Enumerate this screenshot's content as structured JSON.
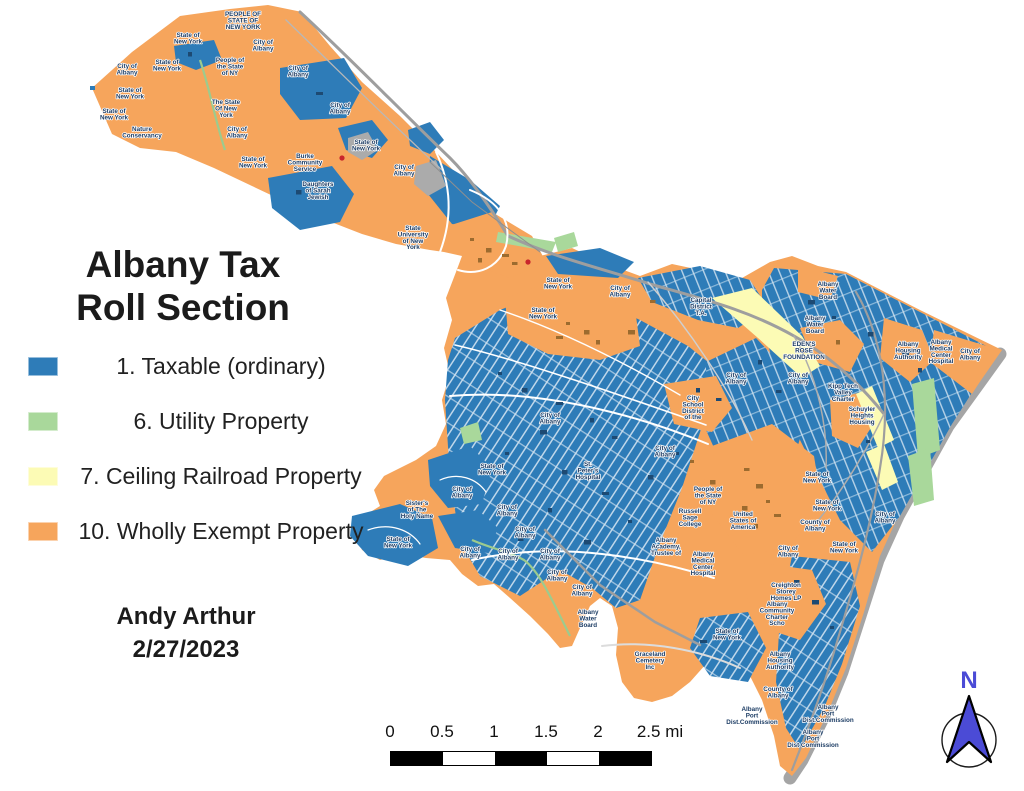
{
  "title": {
    "lines": [
      "Albany Tax",
      "Roll Section"
    ]
  },
  "legend": {
    "items": [
      {
        "label": "1. Taxable (ordinary)",
        "color": "#2E7CB8"
      },
      {
        "label": "6. Utility Property",
        "color": "#A9D89B"
      },
      {
        "label": "7. Ceiling Railroad Property",
        "color": "#FCFBB5"
      },
      {
        "label": "10. Wholly Exempt Property",
        "color": "#F6A55C"
      }
    ]
  },
  "credit": {
    "lines": [
      "Andy Arthur",
      "2/27/2023"
    ]
  },
  "scale_bar": {
    "tick_labels": [
      "0",
      "0.5",
      "1",
      "1.5",
      "2",
      "2.5 mi"
    ],
    "segment_colors": [
      "#000000",
      "#ffffff",
      "#000000",
      "#ffffff",
      "#000000"
    ]
  },
  "compass": {
    "label": "N",
    "color": "#4B4BD6"
  },
  "map": {
    "colors": {
      "taxable_blue": "#2E7CB8",
      "utility_green": "#A9D89B",
      "railroad_yellow": "#FCFBB5",
      "exempt_orange": "#F6A55C",
      "label_navy": "#1C3C64",
      "river_shadow_gray": "#9B9B9B"
    },
    "labels": [
      {
        "x": 243,
        "y": 16,
        "lines": [
          "PEOPLE OF",
          "STATE OF",
          "NEW YORK"
        ]
      },
      {
        "x": 188,
        "y": 37,
        "lines": [
          "State of",
          "New York"
        ]
      },
      {
        "x": 263,
        "y": 44,
        "lines": [
          "City of",
          "Albany"
        ]
      },
      {
        "x": 230,
        "y": 62,
        "lines": [
          "People of",
          "the State",
          "of NY"
        ]
      },
      {
        "x": 167,
        "y": 64,
        "lines": [
          "State of",
          "New York"
        ]
      },
      {
        "x": 127,
        "y": 68,
        "lines": [
          "City of",
          "Albany"
        ]
      },
      {
        "x": 298,
        "y": 70,
        "lines": [
          "City of",
          "Albany"
        ]
      },
      {
        "x": 130,
        "y": 92,
        "lines": [
          "State of",
          "New York"
        ]
      },
      {
        "x": 226,
        "y": 104,
        "lines": [
          "The State",
          "Of New",
          "York"
        ]
      },
      {
        "x": 340,
        "y": 107,
        "lines": [
          "City of",
          "Albany"
        ]
      },
      {
        "x": 114,
        "y": 113,
        "lines": [
          "State of",
          "New York"
        ]
      },
      {
        "x": 237,
        "y": 131,
        "lines": [
          "City of",
          "Albany"
        ]
      },
      {
        "x": 142,
        "y": 131,
        "lines": [
          "Nature",
          "Conservancy"
        ]
      },
      {
        "x": 366,
        "y": 144,
        "lines": [
          "State of",
          "New York"
        ]
      },
      {
        "x": 253,
        "y": 161,
        "lines": [
          "State of",
          "New York"
        ]
      },
      {
        "x": 305,
        "y": 158,
        "lines": [
          "Burke",
          "Community",
          "Service"
        ]
      },
      {
        "x": 404,
        "y": 169,
        "lines": [
          "City of",
          "Albany"
        ]
      },
      {
        "x": 318,
        "y": 186,
        "lines": [
          "Daughters",
          "of Sarah",
          "Jewish"
        ]
      },
      {
        "x": 413,
        "y": 230,
        "lines": [
          "State",
          "University",
          "of New",
          "York"
        ]
      },
      {
        "x": 558,
        "y": 282,
        "lines": [
          "State of",
          "New York"
        ]
      },
      {
        "x": 620,
        "y": 290,
        "lines": [
          "City of",
          "Albany"
        ]
      },
      {
        "x": 701,
        "y": 302,
        "lines": [
          "Capital",
          "District",
          "T.A."
        ]
      },
      {
        "x": 543,
        "y": 312,
        "lines": [
          "State of",
          "New York"
        ]
      },
      {
        "x": 828,
        "y": 286,
        "lines": [
          "Albany",
          "Water",
          "Board"
        ]
      },
      {
        "x": 815,
        "y": 320,
        "lines": [
          "Albany",
          "Water",
          "Board"
        ]
      },
      {
        "x": 804,
        "y": 346,
        "lines": [
          "EDEN'S",
          "ROSE",
          "FOUNDATION"
        ]
      },
      {
        "x": 908,
        "y": 346,
        "lines": [
          "Albany",
          "Housing",
          "Authority"
        ]
      },
      {
        "x": 941,
        "y": 344,
        "lines": [
          "Albany",
          "Medical",
          "Center",
          "Hospital"
        ]
      },
      {
        "x": 970,
        "y": 353,
        "lines": [
          "City of",
          "Albany"
        ]
      },
      {
        "x": 736,
        "y": 377,
        "lines": [
          "City of",
          "Albany"
        ]
      },
      {
        "x": 798,
        "y": 377,
        "lines": [
          "City of",
          "Albany"
        ]
      },
      {
        "x": 843,
        "y": 388,
        "lines": [
          "Kipp Tech",
          "Valley",
          "Charter"
        ]
      },
      {
        "x": 862,
        "y": 411,
        "lines": [
          "Schuyler",
          "Heights",
          "Housing"
        ]
      },
      {
        "x": 693,
        "y": 400,
        "lines": [
          "City",
          "School",
          "District",
          "of the"
        ]
      },
      {
        "x": 550,
        "y": 417,
        "lines": [
          "City of",
          "Albany"
        ]
      },
      {
        "x": 665,
        "y": 450,
        "lines": [
          "City of",
          "Albany"
        ]
      },
      {
        "x": 492,
        "y": 468,
        "lines": [
          "State of",
          "New York"
        ]
      },
      {
        "x": 588,
        "y": 466,
        "lines": [
          "St.",
          "Peter's",
          "Hospital"
        ]
      },
      {
        "x": 462,
        "y": 491,
        "lines": [
          "City of",
          "Albany"
        ]
      },
      {
        "x": 417,
        "y": 505,
        "lines": [
          "Sister's",
          "of The",
          "Holy Name"
        ]
      },
      {
        "x": 507,
        "y": 509,
        "lines": [
          "City of",
          "Albany"
        ]
      },
      {
        "x": 525,
        "y": 531,
        "lines": [
          "City of",
          "Albany"
        ]
      },
      {
        "x": 398,
        "y": 541,
        "lines": [
          "State of",
          "New York"
        ]
      },
      {
        "x": 470,
        "y": 551,
        "lines": [
          "City of",
          "Albany"
        ]
      },
      {
        "x": 508,
        "y": 553,
        "lines": [
          "City of",
          "Albany"
        ]
      },
      {
        "x": 550,
        "y": 553,
        "lines": [
          "City of",
          "Albany"
        ]
      },
      {
        "x": 557,
        "y": 574,
        "lines": [
          "City of",
          "Albany"
        ]
      },
      {
        "x": 582,
        "y": 589,
        "lines": [
          "City of",
          "Albany"
        ]
      },
      {
        "x": 588,
        "y": 614,
        "lines": [
          "Albany",
          "Water",
          "Board"
        ]
      },
      {
        "x": 708,
        "y": 491,
        "lines": [
          "People of",
          "the State",
          "of NY"
        ]
      },
      {
        "x": 690,
        "y": 513,
        "lines": [
          "Russell",
          "Sage",
          "College"
        ]
      },
      {
        "x": 743,
        "y": 516,
        "lines": [
          "United",
          "States of",
          "America"
        ]
      },
      {
        "x": 817,
        "y": 476,
        "lines": [
          "State of",
          "New York"
        ]
      },
      {
        "x": 827,
        "y": 504,
        "lines": [
          "State of",
          "New York"
        ]
      },
      {
        "x": 815,
        "y": 524,
        "lines": [
          "County of",
          "Albany"
        ]
      },
      {
        "x": 885,
        "y": 516,
        "lines": [
          "City of",
          "Albany"
        ]
      },
      {
        "x": 666,
        "y": 542,
        "lines": [
          "Albany",
          "Academy,",
          "Trustee of"
        ]
      },
      {
        "x": 703,
        "y": 556,
        "lines": [
          "Albany",
          "Medical",
          "Center",
          "Hospital"
        ]
      },
      {
        "x": 788,
        "y": 550,
        "lines": [
          "City of",
          "Albany"
        ]
      },
      {
        "x": 844,
        "y": 546,
        "lines": [
          "State of",
          "New York"
        ]
      },
      {
        "x": 786,
        "y": 587,
        "lines": [
          "Creighton",
          "Storey",
          "Homes LP"
        ]
      },
      {
        "x": 777,
        "y": 606,
        "lines": [
          "Albany",
          "Community",
          "Charter",
          "Scho"
        ]
      },
      {
        "x": 727,
        "y": 633,
        "lines": [
          "State of",
          "New York"
        ]
      },
      {
        "x": 650,
        "y": 656,
        "lines": [
          "Graceland",
          "Cemetery",
          "Inc"
        ]
      },
      {
        "x": 780,
        "y": 656,
        "lines": [
          "Albany",
          "Housing",
          "Authority"
        ]
      },
      {
        "x": 778,
        "y": 691,
        "lines": [
          "County of",
          "Albany"
        ]
      },
      {
        "x": 752,
        "y": 711,
        "lines": [
          "Albany",
          "Port",
          "Dist.Commission"
        ]
      },
      {
        "x": 828,
        "y": 709,
        "lines": [
          "Albany",
          "Port",
          "Dist.Commission"
        ]
      },
      {
        "x": 813,
        "y": 734,
        "lines": [
          "Albany",
          "Port",
          "Dist Commission"
        ]
      }
    ]
  }
}
